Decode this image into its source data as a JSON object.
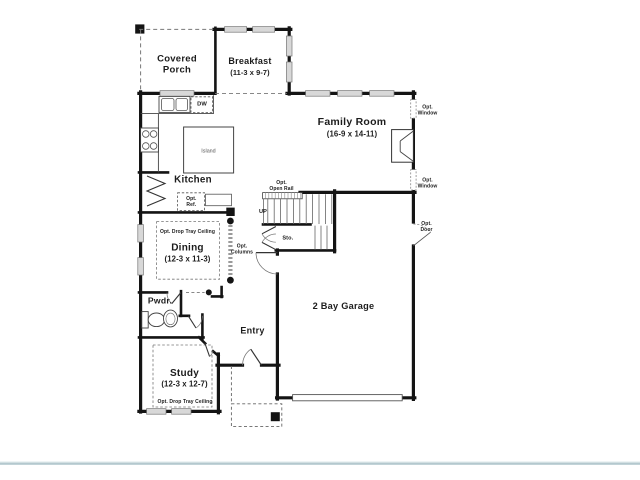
{
  "palette": {
    "wall": "#141414",
    "window_fill": "#d8d8d8",
    "divider": "#b4c8ce",
    "text": "#1c1c1c"
  },
  "rooms": {
    "covered_porch": {
      "line1": "Covered",
      "line2": "Porch"
    },
    "breakfast": {
      "name": "Breakfast",
      "dims": "(11-3 x 9-7)"
    },
    "family_room": {
      "name": "Family Room",
      "dims": "(16-9 x 14-11)"
    },
    "kitchen": {
      "name": "Kitchen"
    },
    "dining": {
      "name": "Dining",
      "dims": "(12-3 x 11-3)",
      "ceiling_note": "Opt. Drop Tray Ceiling"
    },
    "study": {
      "name": "Study",
      "dims": "(12-3 x 12-7)",
      "ceiling_note": "Opt. Drop Tray Ceiling"
    },
    "powder": {
      "name": "Pwdr."
    },
    "entry": {
      "name": "Entry"
    },
    "garage": {
      "name": "2 Bay Garage"
    },
    "storage": {
      "name": "Sto."
    }
  },
  "fixtures": {
    "island": "Island",
    "dishwasher": "DW",
    "stairs_direction": "UP",
    "opt_ref": {
      "line1": "Opt.",
      "line2": "Ref."
    }
  },
  "options": {
    "open_rail": {
      "line1": "Opt.",
      "line2": "Open Rail"
    },
    "window_upper": {
      "line1": "Opt.",
      "line2": "Window"
    },
    "window_lower": {
      "line1": "Opt.",
      "line2": "Window"
    },
    "door": {
      "line1": "Opt.",
      "line2": "Door"
    },
    "columns": {
      "line1": "Opt.",
      "line2": "Columns"
    }
  }
}
